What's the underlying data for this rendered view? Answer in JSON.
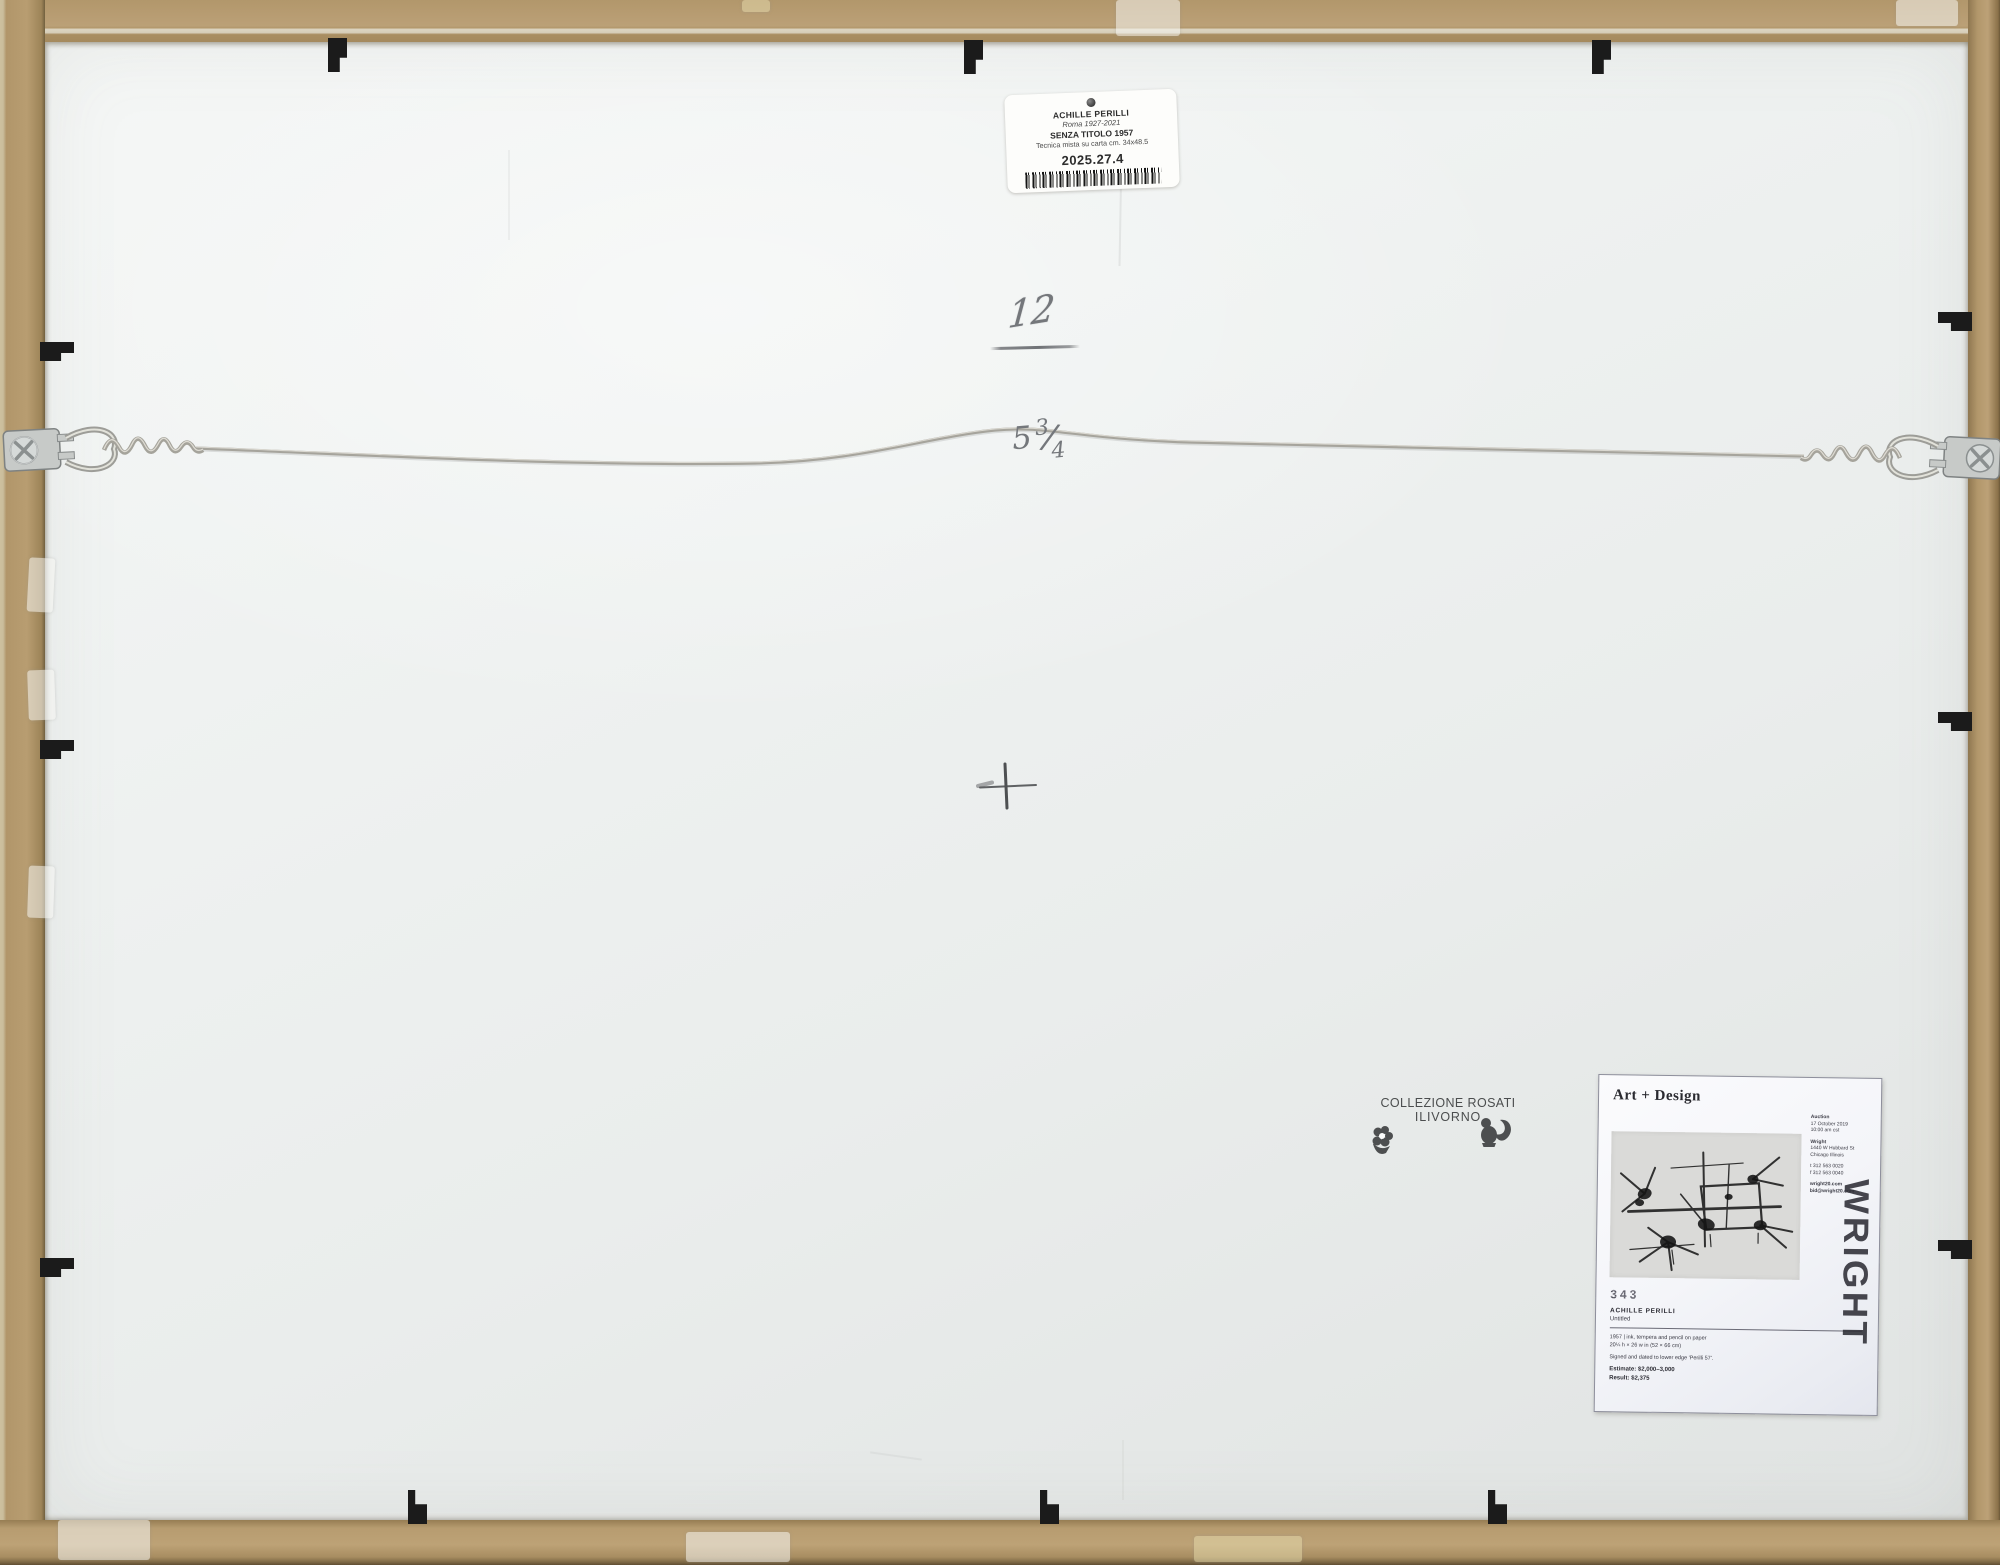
{
  "colors": {
    "frame": "#b79c70",
    "board": "#eef1f0",
    "clip": "#1b1b1b",
    "pencil": "#74777b",
    "label_white": "#fdfdfb"
  },
  "inventory_label": {
    "artist": "ACHILLE PERILLI",
    "artist_dates": "Roma 1927-2021",
    "work_title": "SENZA TITOLO 1957",
    "medium": "Tecnica mista su carta cm. 34x48.5",
    "accession_number": "2025.27.4"
  },
  "handwriting": {
    "number": "12",
    "meas_whole": "5",
    "meas_numerator": "3",
    "meas_slash": "/",
    "meas_denominator": "4"
  },
  "stamp": {
    "line1": "COLLEZIONE ROSATI",
    "line2": "ILIVORNO"
  },
  "auction_label": {
    "title": "Art + Design",
    "auction_heading": "Auction",
    "auction_date": "17 October 2019",
    "auction_time": "10:00 am cst",
    "house_name": "Wright",
    "address1": "1440 W Hubbard St",
    "address2": "Chicago Illinois",
    "phone1": "t 312 563 0020",
    "phone2": "f 312 563 0040",
    "website": "wright20.com",
    "email": "bid@wright20.com",
    "lot_number": "343",
    "artist": "ACHILLE PERILLI",
    "work_title": "Untitled",
    "medium": "1957 | ink, tempera and pencil on paper",
    "dimensions": "20¼ h × 26 w in (52 × 66 cm)",
    "signature": "Signed and dated to lower edge 'Perilli 57'.",
    "estimate": "Estimate: $2,000–3,000",
    "result": "Result: $2,375",
    "logo": "WRIGHT"
  }
}
